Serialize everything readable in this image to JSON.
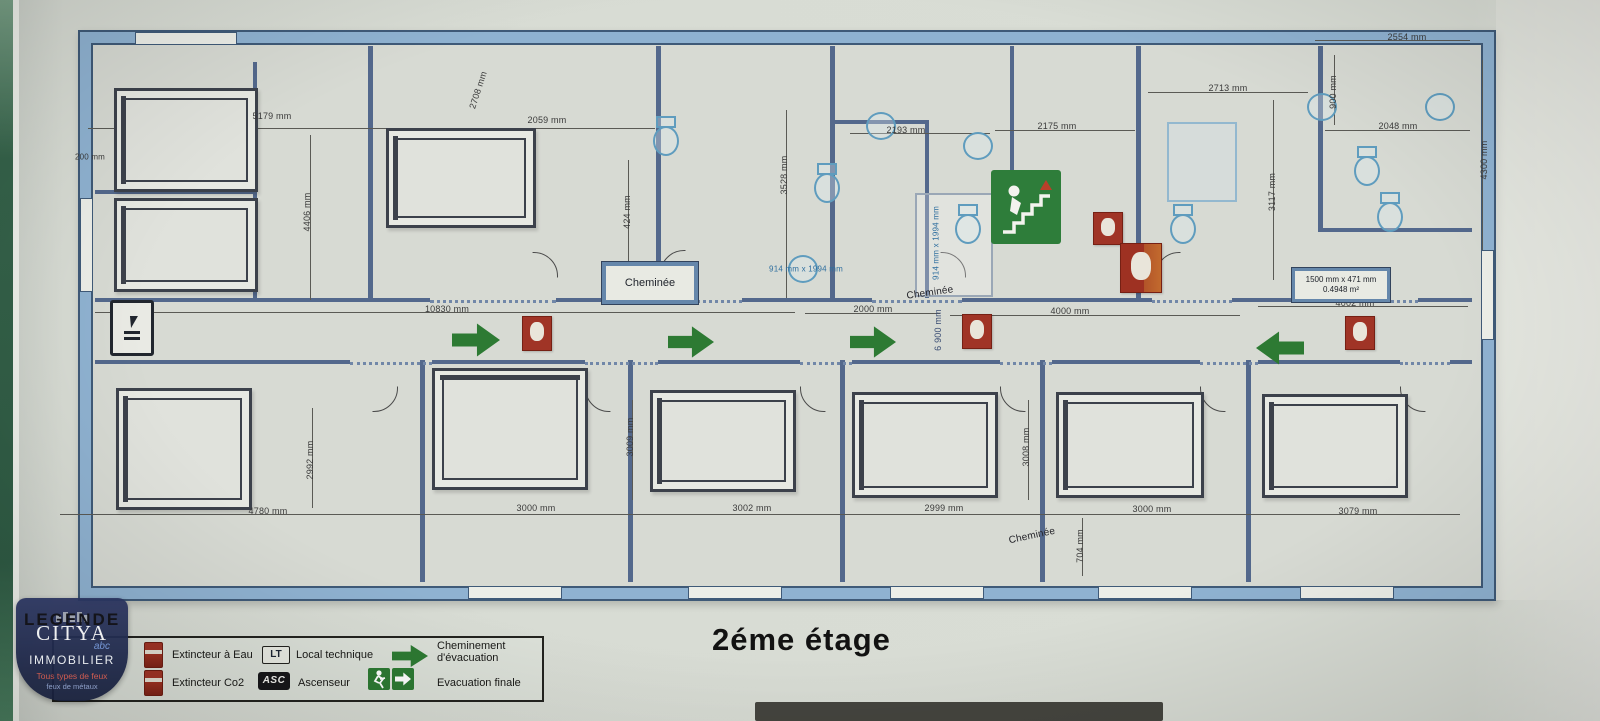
{
  "meta": {
    "title": "2éme étage"
  },
  "plan": {
    "cheminee_box": {
      "text": "Cheminée"
    },
    "area_box": {
      "line1": "1500 mm x 471 mm",
      "line2": "0.4948 m²"
    },
    "dimensions": [
      {
        "t": "200 mm",
        "x": 90,
        "y": 157,
        "r": 0,
        "s": 8
      },
      {
        "t": "5179 mm",
        "x": 272,
        "y": 116,
        "r": 0
      },
      {
        "t": "2059 mm",
        "x": 547,
        "y": 120,
        "r": 0
      },
      {
        "t": "2708 mm",
        "x": 478,
        "y": 90,
        "r": -72
      },
      {
        "t": "2193 mm",
        "x": 906,
        "y": 130,
        "r": 0
      },
      {
        "t": "2175 mm",
        "x": 1057,
        "y": 126,
        "r": 0
      },
      {
        "t": "2713 mm",
        "x": 1228,
        "y": 88,
        "r": 0
      },
      {
        "t": "2554 mm",
        "x": 1407,
        "y": 37,
        "r": 0
      },
      {
        "t": "2048 mm",
        "x": 1398,
        "y": 126,
        "r": 0
      },
      {
        "t": "4406 mm",
        "x": 307,
        "y": 212,
        "r": -90
      },
      {
        "t": "424 mm",
        "x": 627,
        "y": 212,
        "r": -90
      },
      {
        "t": "3528 mm",
        "x": 784,
        "y": 175,
        "r": -90
      },
      {
        "t": "3117 mm",
        "x": 1272,
        "y": 192,
        "r": -90
      },
      {
        "t": "900 mm",
        "x": 1333,
        "y": 92,
        "r": -90
      },
      {
        "t": "4300 mm",
        "x": 1484,
        "y": 160,
        "r": -90
      },
      {
        "t": "6 900 mm",
        "x": 938,
        "y": 330,
        "r": -90,
        "c": "#3c4f75"
      },
      {
        "t": "10830 mm",
        "x": 447,
        "y": 309,
        "r": 0
      },
      {
        "t": "2000 mm",
        "x": 873,
        "y": 309,
        "r": 0
      },
      {
        "t": "4000 mm",
        "x": 1070,
        "y": 311,
        "r": 0
      },
      {
        "t": "4002 mm",
        "x": 1355,
        "y": 303,
        "r": 0
      },
      {
        "t": "2992 mm",
        "x": 310,
        "y": 460,
        "r": -90
      },
      {
        "t": "3009 mm",
        "x": 630,
        "y": 437,
        "r": -90
      },
      {
        "t": "3008 mm",
        "x": 1026,
        "y": 447,
        "r": -90
      },
      {
        "t": "704 mm",
        "x": 1080,
        "y": 546,
        "r": -90
      },
      {
        "t": "4780 mm",
        "x": 268,
        "y": 511,
        "r": 0
      },
      {
        "t": "3000 mm",
        "x": 536,
        "y": 508,
        "r": 0
      },
      {
        "t": "3002 mm",
        "x": 752,
        "y": 508,
        "r": 0
      },
      {
        "t": "2999 mm",
        "x": 944,
        "y": 508,
        "r": 0
      },
      {
        "t": "3000 mm",
        "x": 1152,
        "y": 509,
        "r": 0
      },
      {
        "t": "3079 mm",
        "x": 1358,
        "y": 511,
        "r": 0
      },
      {
        "t": "914 mm x 1994 mm",
        "x": 806,
        "y": 269,
        "r": 0,
        "c": "#2f6f9f",
        "s": 8
      },
      {
        "t": "914 mm x 1994 mm",
        "x": 936,
        "y": 243,
        "r": -90,
        "c": "#2f6f9f",
        "s": 8
      },
      {
        "t": "Cheminée",
        "x": 930,
        "y": 293,
        "r": -8,
        "s": 10,
        "c": "#24242a"
      },
      {
        "t": "Cheminée",
        "x": 1032,
        "y": 536,
        "r": -12,
        "s": 10,
        "c": "#24242a"
      }
    ],
    "walls": [
      [
        368,
        46,
        5,
        254
      ],
      [
        656,
        46,
        5,
        254
      ],
      [
        830,
        46,
        5,
        254
      ],
      [
        925,
        120,
        4,
        178
      ],
      [
        1136,
        46,
        5,
        254
      ],
      [
        1318,
        46,
        5,
        186
      ],
      [
        1010,
        46,
        4,
        126
      ],
      [
        830,
        120,
        99,
        4
      ],
      [
        1318,
        228,
        154,
        4
      ],
      [
        95,
        190,
        160,
        4
      ],
      [
        253,
        62,
        4,
        238
      ],
      [
        95,
        298,
        335,
        4
      ],
      [
        556,
        298,
        104,
        4
      ],
      [
        742,
        298,
        130,
        4
      ],
      [
        962,
        298,
        190,
        4
      ],
      [
        1232,
        298,
        100,
        4
      ],
      [
        1418,
        298,
        54,
        4
      ],
      [
        95,
        360,
        255,
        4
      ],
      [
        432,
        360,
        153,
        4
      ],
      [
        658,
        360,
        142,
        4
      ],
      [
        852,
        360,
        148,
        4
      ],
      [
        1052,
        360,
        148,
        4
      ],
      [
        1258,
        360,
        142,
        4
      ],
      [
        1450,
        360,
        22,
        4
      ],
      [
        420,
        360,
        5,
        222
      ],
      [
        628,
        360,
        5,
        222
      ],
      [
        840,
        360,
        5,
        222
      ],
      [
        1040,
        360,
        5,
        222
      ],
      [
        1246,
        360,
        5,
        222
      ]
    ],
    "dots": [
      [
        430,
        300,
        126
      ],
      [
        660,
        300,
        82
      ],
      [
        872,
        300,
        90
      ],
      [
        1152,
        300,
        80
      ],
      [
        1332,
        300,
        86
      ],
      [
        350,
        362,
        82
      ],
      [
        585,
        362,
        73
      ],
      [
        800,
        362,
        52
      ],
      [
        1000,
        362,
        52
      ],
      [
        1200,
        362,
        58
      ],
      [
        1400,
        362,
        50
      ]
    ],
    "dimlines": [
      [
        88,
        128,
        390,
        1
      ],
      [
        480,
        128,
        175,
        1
      ],
      [
        850,
        133,
        140,
        1
      ],
      [
        995,
        130,
        140,
        1
      ],
      [
        1148,
        92,
        160,
        1
      ],
      [
        1315,
        40,
        155,
        1
      ],
      [
        1325,
        130,
        145,
        1
      ],
      [
        95,
        312,
        700,
        1
      ],
      [
        805,
        313,
        135,
        1
      ],
      [
        950,
        315,
        290,
        1
      ],
      [
        1258,
        306,
        210,
        1
      ],
      [
        60,
        514,
        1400,
        1
      ],
      [
        310,
        135,
        1,
        165
      ],
      [
        628,
        160,
        1,
        138
      ],
      [
        786,
        110,
        1,
        188
      ],
      [
        1273,
        100,
        1,
        180
      ],
      [
        1482,
        60,
        1,
        200
      ],
      [
        1334,
        55,
        1,
        70
      ],
      [
        312,
        408,
        1,
        100
      ],
      [
        632,
        400,
        1,
        100
      ],
      [
        1028,
        400,
        1,
        100
      ],
      [
        1082,
        518,
        1,
        58
      ]
    ],
    "windows": [
      [
        135,
        32,
        100,
        11
      ],
      [
        80,
        198,
        11,
        92
      ],
      [
        468,
        586,
        92,
        11
      ],
      [
        688,
        586,
        92,
        11
      ],
      [
        890,
        586,
        92,
        11
      ],
      [
        1098,
        586,
        92,
        11
      ],
      [
        1300,
        586,
        92,
        11
      ],
      [
        1481,
        250,
        11,
        88
      ]
    ],
    "arcs": [
      [
        510,
        252,
        46,
        90
      ],
      [
        660,
        250,
        46,
        0
      ],
      [
        918,
        252,
        46,
        90
      ],
      [
        1155,
        252,
        46,
        0
      ],
      [
        350,
        364,
        46,
        180
      ],
      [
        585,
        364,
        46,
        270
      ],
      [
        800,
        364,
        46,
        270
      ],
      [
        1000,
        364,
        46,
        270
      ],
      [
        1200,
        364,
        46,
        270
      ],
      [
        1400,
        364,
        46,
        270
      ]
    ],
    "closets": [
      [
        915,
        193,
        74,
        100
      ]
    ],
    "beds": [
      [
        114,
        88,
        138,
        98,
        "left"
      ],
      [
        114,
        198,
        138,
        88,
        "left"
      ],
      [
        386,
        128,
        144,
        94,
        "left"
      ],
      [
        116,
        388,
        130,
        116,
        "left"
      ],
      [
        432,
        368,
        150,
        116,
        "top"
      ],
      [
        650,
        390,
        140,
        96,
        "left"
      ],
      [
        852,
        392,
        140,
        100,
        "left"
      ],
      [
        1056,
        392,
        142,
        100,
        "left"
      ],
      [
        1262,
        394,
        140,
        98,
        "left"
      ]
    ],
    "fixtures": [
      {
        "k": "toilet",
        "x": 651,
        "y": 116
      },
      {
        "k": "toilet",
        "x": 812,
        "y": 163
      },
      {
        "k": "toilet",
        "x": 953,
        "y": 204
      },
      {
        "k": "toilet",
        "x": 1168,
        "y": 204
      },
      {
        "k": "toilet",
        "x": 1352,
        "y": 146
      },
      {
        "k": "toilet",
        "x": 1375,
        "y": 192
      },
      {
        "k": "sink",
        "x": 866,
        "y": 112
      },
      {
        "k": "sink",
        "x": 963,
        "y": 132
      },
      {
        "k": "sink",
        "x": 1307,
        "y": 93
      },
      {
        "k": "sink",
        "x": 1425,
        "y": 93
      },
      {
        "k": "sink",
        "x": 788,
        "y": 255
      },
      {
        "k": "shower",
        "x": 1167,
        "y": 122,
        "w": 66,
        "h": 76
      }
    ],
    "arrows": [
      {
        "dir": "right",
        "x": 452,
        "y": 322,
        "w": 48,
        "h": 36
      },
      {
        "dir": "right",
        "x": 668,
        "y": 325,
        "w": 46,
        "h": 34
      },
      {
        "dir": "right",
        "x": 850,
        "y": 325,
        "w": 46,
        "h": 34
      },
      {
        "dir": "left",
        "x": 1256,
        "y": 330,
        "w": 48,
        "h": 36
      }
    ],
    "extinguishers": [
      {
        "x": 522,
        "y": 316,
        "w": 28,
        "h": 33,
        "kind": "std"
      },
      {
        "x": 962,
        "y": 314,
        "w": 28,
        "h": 33,
        "kind": "std"
      },
      {
        "x": 1093,
        "y": 212,
        "w": 28,
        "h": 31,
        "kind": "std"
      },
      {
        "x": 1345,
        "y": 316,
        "w": 28,
        "h": 32,
        "kind": "std"
      },
      {
        "x": 1120,
        "y": 243,
        "w": 40,
        "h": 48,
        "kind": "co2"
      }
    ]
  },
  "legend": {
    "title": "LEGENDE",
    "items": [
      {
        "icon": "extinguisher-water-icon",
        "label": "Extincteur à Eau"
      },
      {
        "icon": "local-technique-icon",
        "badge": "LT",
        "label": "Local technique"
      },
      {
        "icon": "evacuation-path-icon",
        "label": "Cheminement d'évacuation"
      },
      {
        "icon": "extinguisher-co2-icon",
        "label": "Extincteur Co2"
      },
      {
        "icon": "elevator-icon",
        "badge": "ASC",
        "label": "Ascenseur"
      },
      {
        "icon": "final-exit-icon",
        "label": "Evacuation finale"
      }
    ]
  },
  "logo": {
    "brand": "CITYA",
    "abc": "abc",
    "sub": "IMMOBILIER",
    "tagline1": "Tous types de feux",
    "tagline2": "feux de métaux"
  }
}
